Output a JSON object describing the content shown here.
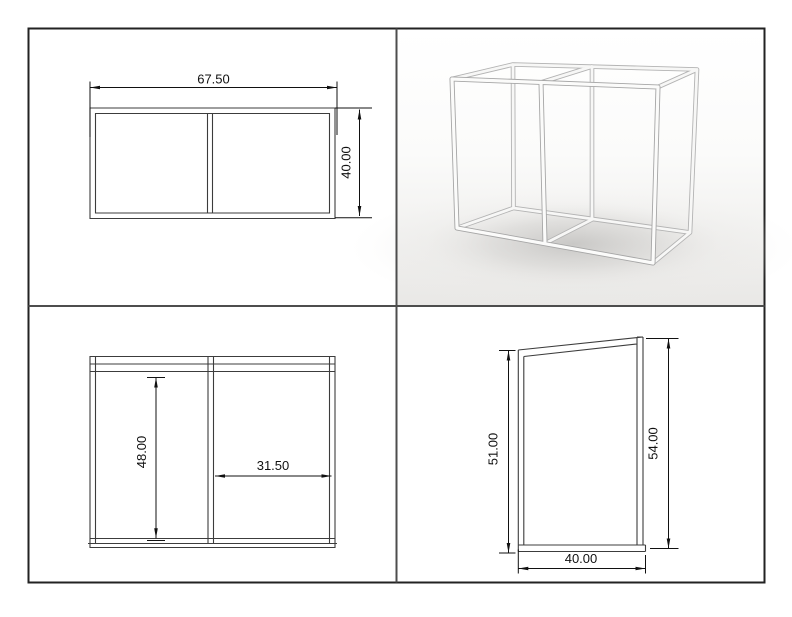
{
  "sheet": {
    "background": "#ffffff",
    "border_color": "#222222",
    "divider_color": "#4d4d4d",
    "line_color": "#3c3c3c",
    "dimension_color": "#111111",
    "render_shadow_color": "#cccbc9"
  },
  "views": {
    "plan": {
      "dims": {
        "width": "67.50",
        "depth": "40.00"
      }
    },
    "front": {
      "dims": {
        "inner_height": "48.00",
        "bay_width": "31.50"
      }
    },
    "side": {
      "dims": {
        "left_height": "51.00",
        "right_height": "54.00",
        "bottom_depth": "40.00"
      }
    }
  }
}
